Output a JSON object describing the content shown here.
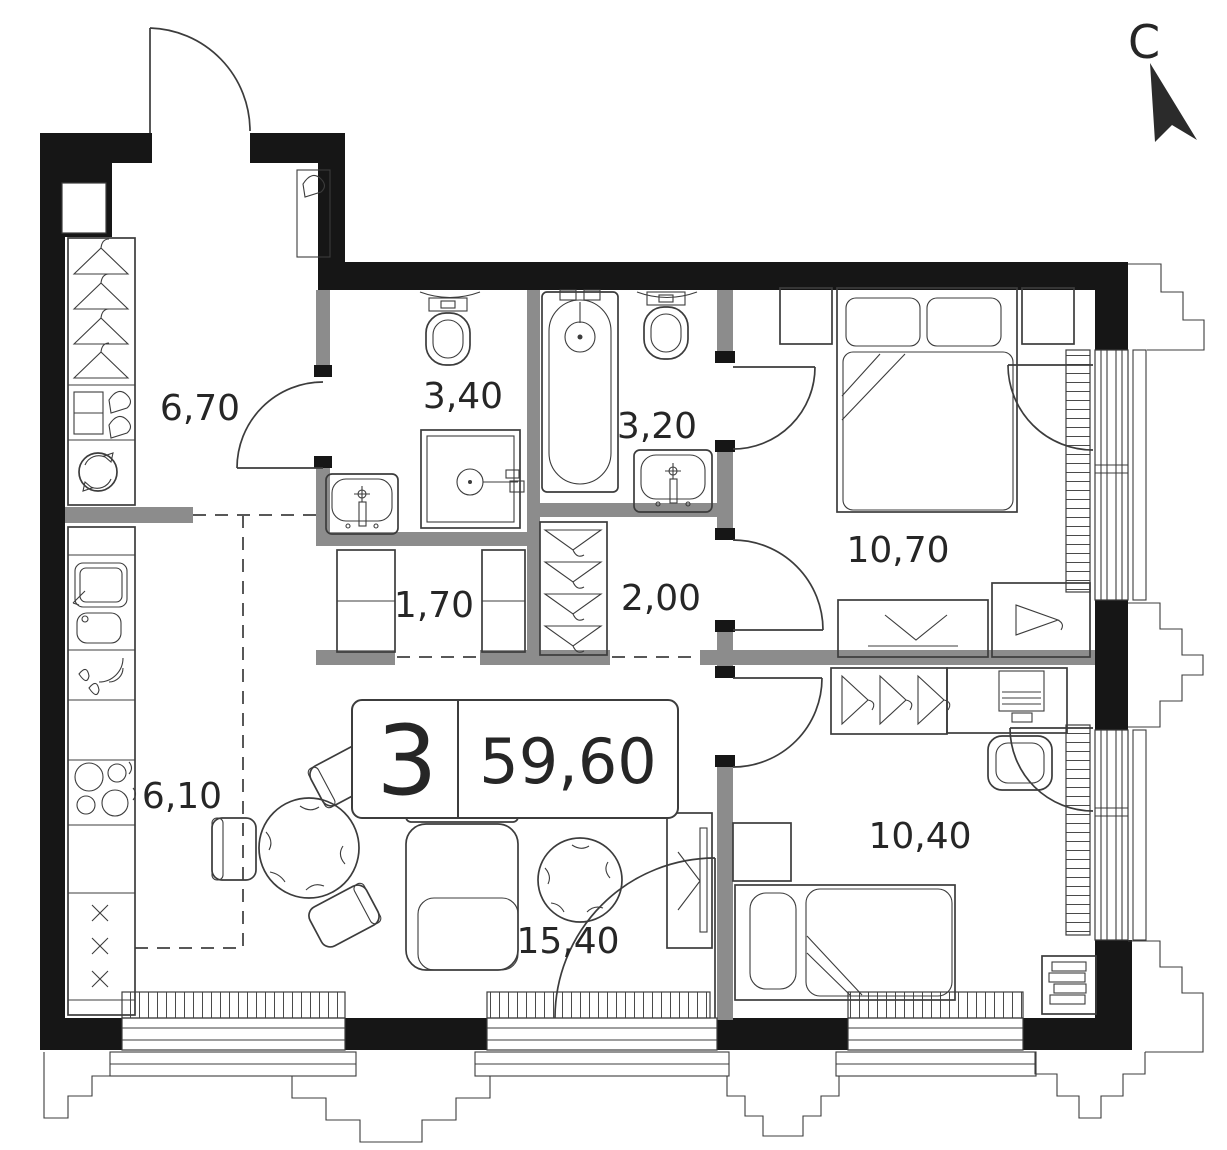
{
  "north": {
    "label": "С"
  },
  "unit_badge": {
    "rooms": "3",
    "area_total": "59,60"
  },
  "rooms": {
    "hallway": {
      "area": "6,70"
    },
    "shower_room": {
      "area": "3,40"
    },
    "bathroom": {
      "area": "3,20"
    },
    "bedroom_master": {
      "area": "10,70"
    },
    "storage": {
      "area": "1,70"
    },
    "closet": {
      "area": "2,00"
    },
    "kitchen": {
      "area": "6,10"
    },
    "living_room": {
      "area": "15,40"
    },
    "bedroom_second": {
      "area": "10,40"
    }
  },
  "colors": {
    "exterior_wall": "#161616",
    "partition_wall": "#8c8c8c",
    "line": "#3c3c3c",
    "text": "#262626",
    "background": "#ffffff"
  }
}
